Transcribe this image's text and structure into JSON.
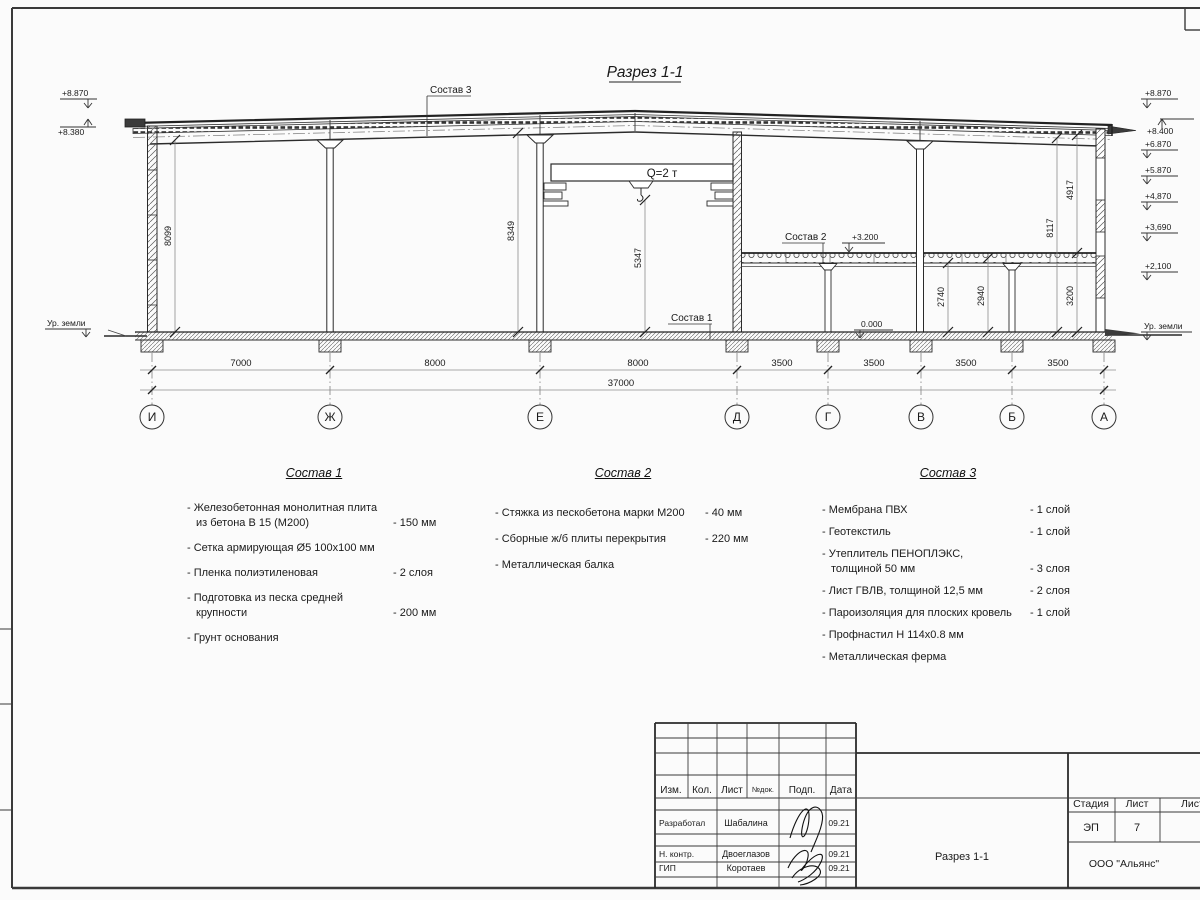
{
  "drawing": {
    "title": "Разрез 1-1",
    "crane": "Q=2 т",
    "marks_left": [
      "+8.870",
      "+8.380",
      "Ур. земли"
    ],
    "marks_right": [
      "+8.870",
      "+8.400",
      "+6.870",
      "+5.870",
      "+4,870",
      "+3,690",
      "+2,100",
      "Ур. земли"
    ],
    "mark_slab": "+3.200",
    "mark_floor": "0.000",
    "dims_v": {
      "h1": "8099",
      "h2": "8349",
      "h3": "5347",
      "h4": "2740",
      "h5": "2940",
      "h6": "3200",
      "h7": "8117",
      "h8": "4917"
    },
    "axes": [
      "И",
      "Ж",
      "Е",
      "Д",
      "Г",
      "В",
      "Б",
      "А"
    ],
    "spans": [
      "7000",
      "8000",
      "8000",
      "3500",
      "3500",
      "3500",
      "3500"
    ],
    "total": "37000",
    "callout1": "Состав 1",
    "callout2": "Состав 2",
    "callout3": "Состав 3"
  },
  "compositions": [
    {
      "title": "Состав 1",
      "rows": [
        {
          "t": "- Железобетонная  монолитная плита",
          "v": ""
        },
        {
          "t": "из бетона В 15 (М200)",
          "v": "- 150 мм"
        },
        {
          "t": "- Сетка армирующая Ø5 100х100 мм",
          "v": ""
        },
        {
          "t": "- Пленка полиэтиленовая",
          "v": "-  2 слоя"
        },
        {
          "t": "- Подготовка из песка средней",
          "v": ""
        },
        {
          "t": "крупности",
          "v": "- 200 мм"
        },
        {
          "t": "- Грунт основания",
          "v": ""
        }
      ]
    },
    {
      "title": "Состав 2",
      "rows": [
        {
          "t": "- Стяжка из пескобетона марки М200",
          "v": "- 40 мм"
        },
        {
          "t": "- Сборные ж/б плиты перекрытия",
          "v": "- 220 мм"
        },
        {
          "t": "- Металлическая балка",
          "v": ""
        }
      ]
    },
    {
      "title": "Состав 3",
      "rows": [
        {
          "t": "- Мембрана ПВХ",
          "v": "- 1 слой"
        },
        {
          "t": "- Геотекстиль",
          "v": "- 1 слой"
        },
        {
          "t": "- Утеплитель ПЕНОПЛЭКС,",
          "v": ""
        },
        {
          "t": "толщиной 50 мм",
          "v": "- 3 слоя"
        },
        {
          "t": "- Лист ГВЛВ, толщиной 12,5 мм",
          "v": "- 2 слоя"
        },
        {
          "t": "- Пароизоляция для плоских кровель",
          "v": "- 1 слой"
        },
        {
          "t": "- Профнастил Н 114х0.8 мм",
          "v": ""
        },
        {
          "t": "- Металлическая ферма",
          "v": ""
        }
      ]
    }
  ],
  "stamp": {
    "header": {
      "izm": "Изм.",
      "kol": "Кол.",
      "list": "Лист",
      "ndok": "№док.",
      "podp": "Подп.",
      "data": "Дата"
    },
    "rows": [
      {
        "role": "Разработал",
        "name": "Шабалина",
        "date": "09.21"
      },
      {
        "role": "Н. контр.",
        "name": "Двоеглазов",
        "date": "09.21"
      },
      {
        "role": "ГИП",
        "name": "Коротаев",
        "date": "09.21"
      }
    ],
    "stage_label": "Стадия",
    "sheet_label": "Лист",
    "sheets_label": "Листов",
    "stage": "ЭП",
    "sheet_no": "7",
    "doc_title": "Разрез 1-1",
    "company": "ООО \"Альянс\""
  }
}
